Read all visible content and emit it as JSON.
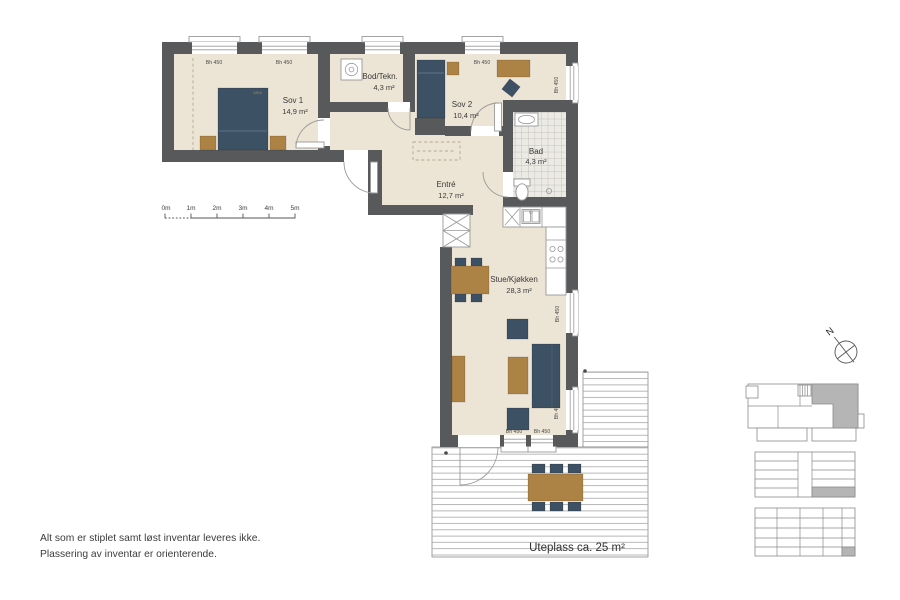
{
  "palette": {
    "wall": "#58595b",
    "floor": "#ece4d5",
    "blue": "#3d5164",
    "wood": "#ad8245",
    "highlight": "#b5b5b5",
    "text": "#3a3a3a"
  },
  "rooms": {
    "sov1": {
      "name": "Sov 1",
      "area": "14,9 m²"
    },
    "bod": {
      "name": "Bod/Tekn.",
      "area": "4,3 m²"
    },
    "sov2": {
      "name": "Sov 2",
      "area": "10,4 m²"
    },
    "bad": {
      "name": "Bad",
      "area": "4,3 m²"
    },
    "entre": {
      "name": "Entré",
      "area": "12,7 m²"
    },
    "stue": {
      "name": "Stue/Kjøkken",
      "area": "28,3 m²"
    }
  },
  "terrace": {
    "label": "Uteplass ca. 25 m²"
  },
  "windows": {
    "sill_label": "Bh 450"
  },
  "bed": {
    "dimension_label": "1800"
  },
  "scale_bar": {
    "ticks": [
      "0m",
      "1m",
      "2m",
      "3m",
      "4m",
      "5m"
    ]
  },
  "compass": {
    "north_label": "N"
  },
  "disclaimer": {
    "line1": "Alt som er stiplet samt løst inventar leveres ikke.",
    "line2": "Plassering av inventar er orienterende."
  }
}
